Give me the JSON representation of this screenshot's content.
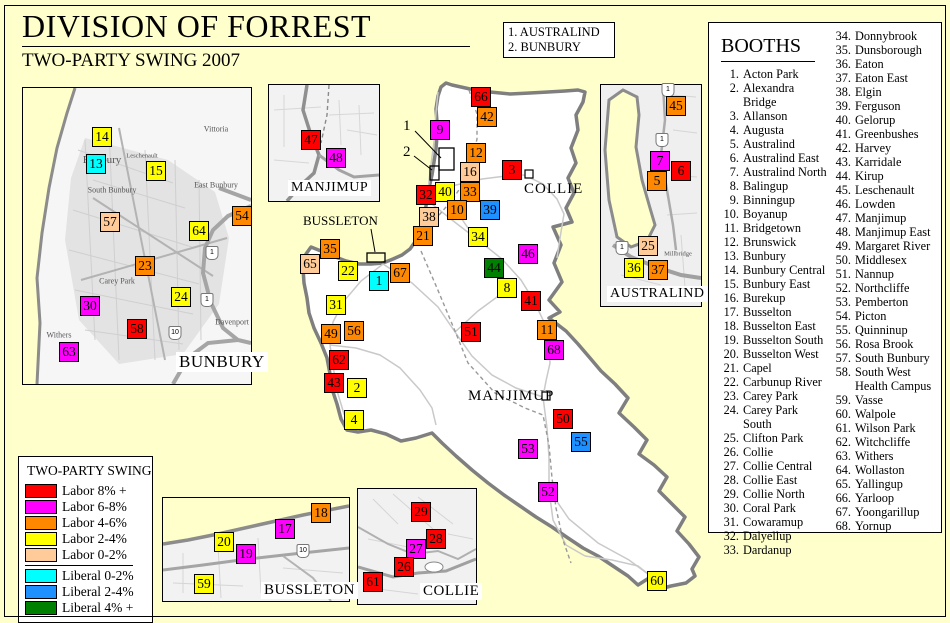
{
  "header": {
    "title": "DIVISION OF FORREST",
    "subtitle": "TWO-PARTY SWING 2007"
  },
  "callout_box": {
    "line1": "1. AUSTRALIND",
    "line2": "2. BUNBURY"
  },
  "booths_panel": {
    "heading": "BOOTHS",
    "items": [
      {
        "n": 1,
        "name": "Acton Park"
      },
      {
        "n": 2,
        "name": "Alexandra Bridge"
      },
      {
        "n": 3,
        "name": "Allanson"
      },
      {
        "n": 4,
        "name": "Augusta"
      },
      {
        "n": 5,
        "name": "Australind"
      },
      {
        "n": 6,
        "name": "Australind East"
      },
      {
        "n": 7,
        "name": "Australind North"
      },
      {
        "n": 8,
        "name": "Balingup"
      },
      {
        "n": 9,
        "name": "Binningup"
      },
      {
        "n": 10,
        "name": "Boyanup"
      },
      {
        "n": 11,
        "name": "Bridgetown"
      },
      {
        "n": 12,
        "name": "Brunswick"
      },
      {
        "n": 13,
        "name": "Bunbury"
      },
      {
        "n": 14,
        "name": "Bunbury Central"
      },
      {
        "n": 15,
        "name": "Bunbury East"
      },
      {
        "n": 16,
        "name": "Burekup"
      },
      {
        "n": 17,
        "name": "Busselton"
      },
      {
        "n": 18,
        "name": "Busselton East"
      },
      {
        "n": 19,
        "name": "Busselton South"
      },
      {
        "n": 20,
        "name": "Busselton West"
      },
      {
        "n": 21,
        "name": "Capel"
      },
      {
        "n": 22,
        "name": "Carbunup River"
      },
      {
        "n": 23,
        "name": "Carey Park"
      },
      {
        "n": 24,
        "name": "Carey Park South"
      },
      {
        "n": 25,
        "name": "Clifton Park"
      },
      {
        "n": 26,
        "name": "Collie"
      },
      {
        "n": 27,
        "name": "Collie Central"
      },
      {
        "n": 28,
        "name": "Collie East"
      },
      {
        "n": 29,
        "name": "Collie North"
      },
      {
        "n": 30,
        "name": "Coral Park"
      },
      {
        "n": 31,
        "name": "Cowaramup"
      },
      {
        "n": 32,
        "name": "Dalyellup"
      },
      {
        "n": 33,
        "name": "Dardanup"
      },
      {
        "n": 34,
        "name": "Donnybrook"
      },
      {
        "n": 35,
        "name": "Dunsborough"
      },
      {
        "n": 36,
        "name": "Eaton"
      },
      {
        "n": 37,
        "name": "Eaton East"
      },
      {
        "n": 38,
        "name": "Elgin"
      },
      {
        "n": 39,
        "name": "Ferguson"
      },
      {
        "n": 40,
        "name": "Gelorup"
      },
      {
        "n": 41,
        "name": "Greenbushes"
      },
      {
        "n": 42,
        "name": "Harvey"
      },
      {
        "n": 43,
        "name": "Karridale"
      },
      {
        "n": 44,
        "name": "Kirup"
      },
      {
        "n": 45,
        "name": "Leschenault"
      },
      {
        "n": 46,
        "name": "Lowden"
      },
      {
        "n": 47,
        "name": "Manjimup"
      },
      {
        "n": 48,
        "name": "Manjimup East"
      },
      {
        "n": 49,
        "name": "Margaret River"
      },
      {
        "n": 50,
        "name": "Middlesex"
      },
      {
        "n": 51,
        "name": "Nannup"
      },
      {
        "n": 52,
        "name": "Northcliffe"
      },
      {
        "n": 53,
        "name": "Pemberton"
      },
      {
        "n": 54,
        "name": "Picton"
      },
      {
        "n": 55,
        "name": "Quinninup"
      },
      {
        "n": 56,
        "name": "Rosa Brook"
      },
      {
        "n": 57,
        "name": "South Bunbury"
      },
      {
        "n": 58,
        "name": "South West Health Campus",
        "display_lines": [
          "South West",
          "Health Campus"
        ]
      },
      {
        "n": 59,
        "name": "Vasse"
      },
      {
        "n": 60,
        "name": "Walpole"
      },
      {
        "n": 61,
        "name": "Wilson Park"
      },
      {
        "n": 62,
        "name": "Witchcliffe"
      },
      {
        "n": 63,
        "name": "Withers"
      },
      {
        "n": 64,
        "name": "Wollaston"
      },
      {
        "n": 65,
        "name": "Yallingup"
      },
      {
        "n": 66,
        "name": "Yarloop"
      },
      {
        "n": 67,
        "name": "Yoongarillup"
      },
      {
        "n": 68,
        "name": "Yornup"
      }
    ]
  },
  "legend": {
    "title": "TWO-PARTY SWING",
    "entries": [
      {
        "label": "Labor 8% +",
        "cat": "labor8"
      },
      {
        "label": "Labor 6-8%",
        "cat": "labor68"
      },
      {
        "label": "Labor 4-6%",
        "cat": "labor46"
      },
      {
        "label": "Labor 2-4%",
        "cat": "labor24"
      },
      {
        "label": "Labor 0-2%",
        "cat": "labor02"
      },
      {
        "label": "Liberal 0-2%",
        "cat": "lib02",
        "divider_before": true
      },
      {
        "label": "Liberal 2-4%",
        "cat": "lib24"
      },
      {
        "label": "Liberal 4% +",
        "cat": "lib4"
      }
    ]
  },
  "swing_colors": {
    "labor8": "#FF0000",
    "labor68": "#FF00FF",
    "labor46": "#FF8800",
    "labor24": "#FFFF00",
    "labor02": "#FFCC99",
    "lib02": "#00FFFF",
    "lib24": "#1E90FF",
    "lib4": "#008000"
  },
  "map": {
    "town_labels": [
      {
        "text": "COLLIE",
        "x": 524,
        "y": 181
      },
      {
        "text": "MANJIMUP",
        "x": 468,
        "y": 388
      }
    ],
    "callouts": [
      {
        "text": "1",
        "x": 403,
        "y": 118
      },
      {
        "text": "2",
        "x": 403,
        "y": 144
      },
      {
        "text": "BUSSLETON",
        "x": 303,
        "y": 213
      }
    ],
    "markers": [
      {
        "n": 66,
        "x": 481,
        "y": 97,
        "cat": "labor8"
      },
      {
        "n": 42,
        "x": 487,
        "y": 117,
        "cat": "labor46"
      },
      {
        "n": 9,
        "x": 440,
        "y": 130,
        "cat": "labor68"
      },
      {
        "n": 12,
        "x": 476,
        "y": 153,
        "cat": "labor46"
      },
      {
        "n": 3,
        "x": 512,
        "y": 170,
        "cat": "labor8"
      },
      {
        "n": 16,
        "x": 470,
        "y": 172,
        "cat": "labor02"
      },
      {
        "n": 32,
        "x": 426,
        "y": 195,
        "cat": "labor8"
      },
      {
        "n": 40,
        "x": 445,
        "y": 192,
        "cat": "labor24"
      },
      {
        "n": 33,
        "x": 470,
        "y": 192,
        "cat": "labor46"
      },
      {
        "n": 10,
        "x": 457,
        "y": 210,
        "cat": "labor46"
      },
      {
        "n": 39,
        "x": 490,
        "y": 210,
        "cat": "lib24"
      },
      {
        "n": 38,
        "x": 429,
        "y": 217,
        "cat": "labor02"
      },
      {
        "n": 21,
        "x": 423,
        "y": 236,
        "cat": "labor46"
      },
      {
        "n": 34,
        "x": 478,
        "y": 237,
        "cat": "labor24"
      },
      {
        "n": 35,
        "x": 330,
        "y": 249,
        "cat": "labor46"
      },
      {
        "n": 65,
        "x": 310,
        "y": 264,
        "cat": "labor02"
      },
      {
        "n": 22,
        "x": 348,
        "y": 271,
        "cat": "labor24"
      },
      {
        "n": 67,
        "x": 400,
        "y": 273,
        "cat": "labor46"
      },
      {
        "n": 1,
        "x": 379,
        "y": 281,
        "cat": "lib02"
      },
      {
        "n": 46,
        "x": 528,
        "y": 254,
        "cat": "labor68"
      },
      {
        "n": 44,
        "x": 494,
        "y": 268,
        "cat": "lib4"
      },
      {
        "n": 8,
        "x": 507,
        "y": 288,
        "cat": "labor24"
      },
      {
        "n": 41,
        "x": 531,
        "y": 301,
        "cat": "labor8"
      },
      {
        "n": 31,
        "x": 336,
        "y": 305,
        "cat": "labor24"
      },
      {
        "n": 49,
        "x": 331,
        "y": 334,
        "cat": "labor46"
      },
      {
        "n": 56,
        "x": 354,
        "y": 331,
        "cat": "labor46"
      },
      {
        "n": 51,
        "x": 471,
        "y": 332,
        "cat": "labor8"
      },
      {
        "n": 11,
        "x": 547,
        "y": 330,
        "cat": "labor46"
      },
      {
        "n": 68,
        "x": 554,
        "y": 350,
        "cat": "labor68"
      },
      {
        "n": 62,
        "x": 339,
        "y": 360,
        "cat": "labor8"
      },
      {
        "n": 43,
        "x": 334,
        "y": 383,
        "cat": "labor8"
      },
      {
        "n": 2,
        "x": 357,
        "y": 388,
        "cat": "labor24"
      },
      {
        "n": 4,
        "x": 354,
        "y": 420,
        "cat": "labor24"
      },
      {
        "n": 50,
        "x": 563,
        "y": 419,
        "cat": "labor8"
      },
      {
        "n": 55,
        "x": 581,
        "y": 442,
        "cat": "lib24"
      },
      {
        "n": 53,
        "x": 528,
        "y": 449,
        "cat": "labor68"
      },
      {
        "n": 52,
        "x": 548,
        "y": 492,
        "cat": "labor68"
      },
      {
        "n": 60,
        "x": 657,
        "y": 581,
        "cat": "labor24"
      },
      {
        "n": 14,
        "x": 102,
        "y": 137,
        "cat": "labor24"
      },
      {
        "n": 13,
        "x": 96,
        "y": 164,
        "cat": "lib02"
      },
      {
        "n": 15,
        "x": 156,
        "y": 171,
        "cat": "labor24"
      },
      {
        "n": 57,
        "x": 110,
        "y": 222,
        "cat": "labor02"
      },
      {
        "n": 64,
        "x": 199,
        "y": 231,
        "cat": "labor24"
      },
      {
        "n": 54,
        "x": 242,
        "y": 216,
        "cat": "labor46"
      },
      {
        "n": 23,
        "x": 145,
        "y": 266,
        "cat": "labor46"
      },
      {
        "n": 24,
        "x": 181,
        "y": 297,
        "cat": "labor24"
      },
      {
        "n": 30,
        "x": 90,
        "y": 306,
        "cat": "labor68"
      },
      {
        "n": 58,
        "x": 137,
        "y": 329,
        "cat": "labor8"
      },
      {
        "n": 63,
        "x": 69,
        "y": 352,
        "cat": "labor68"
      },
      {
        "n": 47,
        "x": 311,
        "y": 140,
        "cat": "labor8"
      },
      {
        "n": 48,
        "x": 336,
        "y": 158,
        "cat": "labor68"
      },
      {
        "n": 45,
        "x": 676,
        "y": 106,
        "cat": "labor46"
      },
      {
        "n": 7,
        "x": 660,
        "y": 161,
        "cat": "labor68"
      },
      {
        "n": 6,
        "x": 681,
        "y": 171,
        "cat": "labor8"
      },
      {
        "n": 5,
        "x": 657,
        "y": 181,
        "cat": "labor46"
      },
      {
        "n": 25,
        "x": 648,
        "y": 246,
        "cat": "labor02"
      },
      {
        "n": 36,
        "x": 634,
        "y": 268,
        "cat": "labor24"
      },
      {
        "n": 37,
        "x": 658,
        "y": 270,
        "cat": "labor46"
      },
      {
        "n": 18,
        "x": 321,
        "y": 513,
        "cat": "labor46"
      },
      {
        "n": 17,
        "x": 285,
        "y": 529,
        "cat": "labor68"
      },
      {
        "n": 20,
        "x": 224,
        "y": 542,
        "cat": "labor24"
      },
      {
        "n": 19,
        "x": 246,
        "y": 554,
        "cat": "labor68"
      },
      {
        "n": 59,
        "x": 204,
        "y": 584,
        "cat": "labor24"
      },
      {
        "n": 29,
        "x": 421,
        "y": 512,
        "cat": "labor8"
      },
      {
        "n": 28,
        "x": 436,
        "y": 539,
        "cat": "labor8"
      },
      {
        "n": 27,
        "x": 416,
        "y": 549,
        "cat": "labor68"
      },
      {
        "n": 26,
        "x": 404,
        "y": 567,
        "cat": "labor8"
      },
      {
        "n": 61,
        "x": 373,
        "y": 582,
        "cat": "labor8"
      }
    ],
    "place_labels": [
      {
        "text": "Vittoria",
        "x": 216,
        "y": 129,
        "s": 8
      },
      {
        "text": "East Bunbury",
        "x": 216,
        "y": 185,
        "s": 8
      },
      {
        "text": "South Bunbury",
        "x": 112,
        "y": 190,
        "s": 8
      },
      {
        "text": "Bunbury",
        "x": 102,
        "y": 160,
        "s": 11
      },
      {
        "text": "Carey Park",
        "x": 117,
        "y": 281,
        "s": 8
      },
      {
        "text": "Withers",
        "x": 59,
        "y": 335,
        "s": 8
      },
      {
        "text": "Davenport",
        "x": 232,
        "y": 322,
        "s": 8
      },
      {
        "text": "Leschenault",
        "x": 142,
        "y": 156,
        "s": 6.5
      },
      {
        "text": "Millbridge",
        "x": 678,
        "y": 254,
        "s": 6.5
      }
    ],
    "route_shields": [
      {
        "label": "1",
        "x": 212,
        "y": 253
      },
      {
        "label": "1",
        "x": 207,
        "y": 300
      },
      {
        "label": "10",
        "x": 175,
        "y": 333
      },
      {
        "label": "1",
        "x": 668,
        "y": 90
      },
      {
        "label": "1",
        "x": 662,
        "y": 140
      },
      {
        "label": "1",
        "x": 622,
        "y": 248
      },
      {
        "label": "10",
        "x": 303,
        "y": 551
      }
    ]
  },
  "insets": {
    "bunbury": {
      "label": "BUNBURY"
    },
    "manjimup": {
      "label": "MANJIMUP"
    },
    "australind": {
      "label": "AUSTRALIND"
    },
    "bussleton": {
      "label": "BUSSLETON"
    },
    "collie": {
      "label": "COLLIE"
    }
  }
}
